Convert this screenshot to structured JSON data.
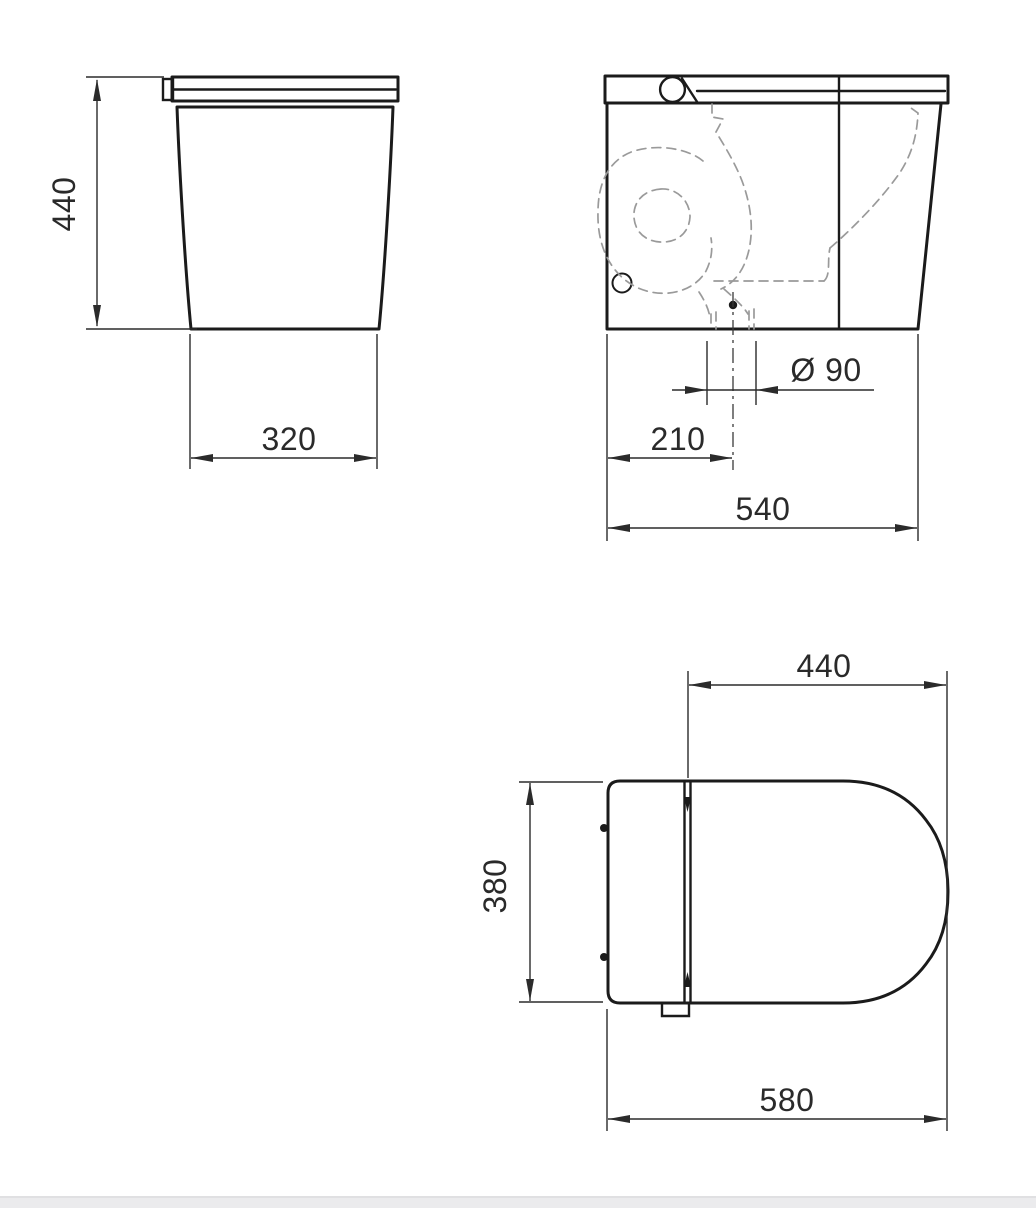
{
  "drawing": {
    "type": "technical-drawing",
    "subject": "floor-standing smart toilet, three orthographic views with dimensions",
    "units": "mm",
    "colors": {
      "outline": "#1b1b1b",
      "dimension": "#2b2b2b",
      "hidden_line": "#9a9a9a",
      "background": "#ffffff",
      "footer_strip": "#ebebed"
    },
    "views": {
      "front": {
        "label": "front view",
        "dims": {
          "height": "440",
          "base_depth": "320"
        }
      },
      "side": {
        "label": "side view",
        "dims": {
          "outlet_diameter": "Ø 90",
          "outlet_center_offset": "210",
          "overall_depth": "540"
        }
      },
      "top": {
        "label": "top view",
        "dims": {
          "seat_depth": "440",
          "width": "380",
          "overall_depth": "580"
        }
      }
    }
  }
}
